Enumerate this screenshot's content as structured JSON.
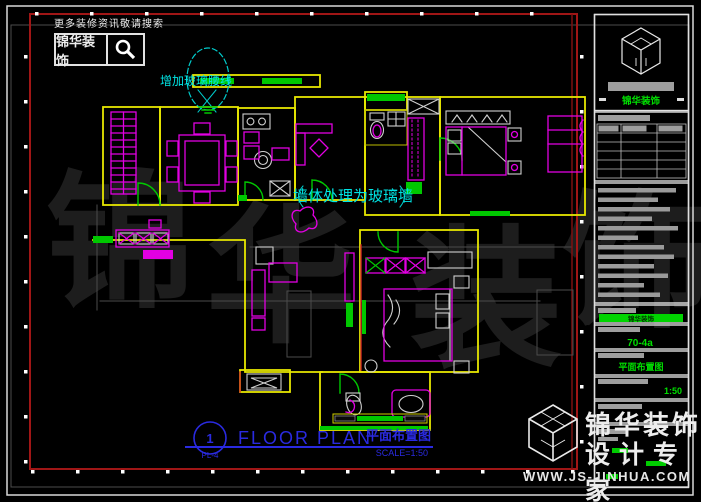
{
  "colors": {
    "wall_yellow": "#e6e600",
    "furniture_magenta": "#e200e2",
    "accent_green": "#00c800",
    "annotation_cyan": "#00dcdc",
    "title_blue": "#2a2ae0",
    "border_red": "#a01616",
    "brand_green": "#00e000"
  },
  "search_widget": {
    "hint": "更多装修资讯敬请搜索",
    "brand": "锦华装饰"
  },
  "annotations": {
    "top": "增加玻璃腰线",
    "middle": "墙体处理为玻璃墙"
  },
  "plan_title": {
    "number": "1",
    "sheet": "PL-4",
    "title_en": "FLOOR PLAN",
    "title_cn": "平面布置图",
    "scale": "SCALE=1:50"
  },
  "title_block": {
    "brand_green": "锦华装饰",
    "fields": {
      "project": "锦华装饰",
      "unit": "70-4a",
      "drawing": "平面布置图",
      "scale": "1:50"
    }
  },
  "footer_brand": {
    "line1": "锦华装饰",
    "line2": "设计专家",
    "url": "WWW.JS-JINHUA.COM"
  },
  "watermark": {
    "c1": "锦",
    "c2": "华",
    "c3": "装",
    "c4": "饰"
  }
}
